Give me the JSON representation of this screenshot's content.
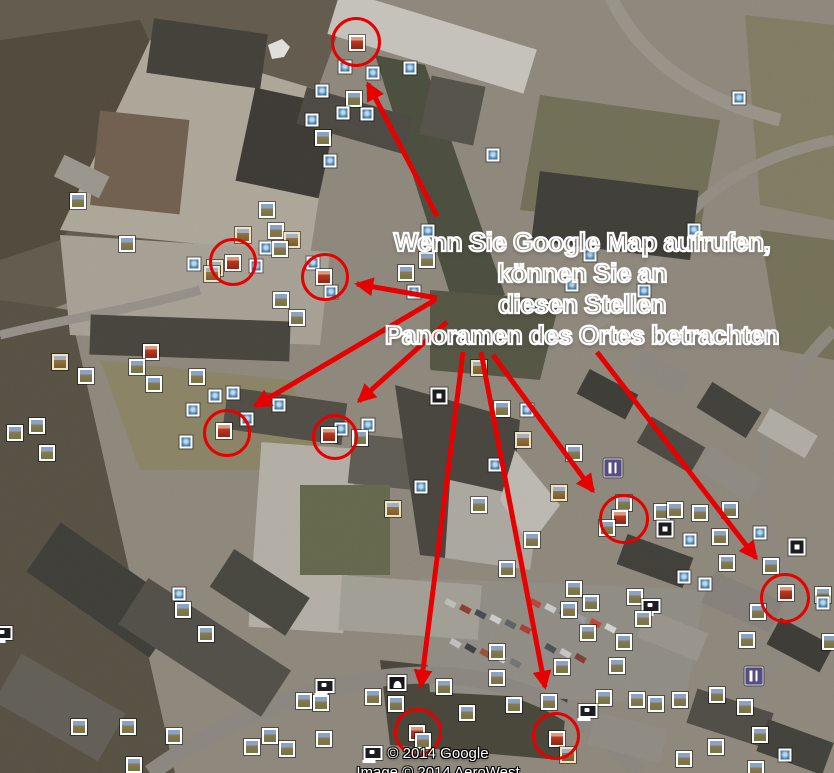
{
  "annotation": {
    "color": "#e60000",
    "text_lines": [
      "Wenn Sie Google Map aufrufen,",
      "können Sie an",
      "diesen Stellen",
      "Panoramen des Ortes betrachten"
    ],
    "circles": [
      {
        "cx": 356,
        "cy": 42,
        "r": 22
      },
      {
        "cx": 233,
        "cy": 262,
        "r": 21
      },
      {
        "cx": 325,
        "cy": 277,
        "r": 21
      },
      {
        "cx": 227,
        "cy": 433,
        "r": 21
      },
      {
        "cx": 335,
        "cy": 437,
        "r": 20
      },
      {
        "cx": 624,
        "cy": 519,
        "r": 22
      },
      {
        "cx": 785,
        "cy": 598,
        "r": 22
      },
      {
        "cx": 418,
        "cy": 732,
        "r": 21
      },
      {
        "cx": 556,
        "cy": 736,
        "r": 21
      }
    ],
    "arrows": [
      {
        "x1": 437,
        "y1": 216,
        "x2": 368,
        "y2": 84
      },
      {
        "x1": 437,
        "y1": 298,
        "x2": 357,
        "y2": 284
      },
      {
        "x1": 435,
        "y1": 300,
        "x2": 255,
        "y2": 406
      },
      {
        "x1": 447,
        "y1": 322,
        "x2": 359,
        "y2": 401
      },
      {
        "x1": 463,
        "y1": 352,
        "x2": 421,
        "y2": 686
      },
      {
        "x1": 481,
        "y1": 352,
        "x2": 545,
        "y2": 687
      },
      {
        "x1": 493,
        "y1": 355,
        "x2": 593,
        "y2": 491
      },
      {
        "x1": 597,
        "y1": 352,
        "x2": 756,
        "y2": 558
      }
    ]
  },
  "attribution": {
    "line1": "© 2014 Google",
    "line2": "Image © 2014 AeroWest"
  },
  "marker_legend": {
    "photo": "photo-placemark",
    "photo2": "photo-placemark-vintage-frame",
    "blue": "small-photo-placemark",
    "red": "highlighted-panorama-placemark",
    "webcam": "webcam-placemark",
    "restaurant": "restaurant-placemark",
    "sphere": "photosphere-placemark",
    "monument": "monument-placemark"
  },
  "markers": [
    [
      357,
      43,
      "red"
    ],
    [
      345,
      67,
      "blue"
    ],
    [
      373,
      73,
      "blue"
    ],
    [
      410,
      68,
      "blue"
    ],
    [
      322,
      91,
      "blue"
    ],
    [
      354,
      99,
      "photo"
    ],
    [
      343,
      113,
      "blue"
    ],
    [
      367,
      114,
      "blue"
    ],
    [
      312,
      120,
      "blue"
    ],
    [
      323,
      138,
      "photo"
    ],
    [
      330,
      161,
      "blue"
    ],
    [
      428,
      231,
      "blue"
    ],
    [
      427,
      260,
      "photo"
    ],
    [
      406,
      273,
      "photo"
    ],
    [
      414,
      292,
      "blue"
    ],
    [
      78,
      201,
      "photo"
    ],
    [
      127,
      244,
      "photo"
    ],
    [
      267,
      210,
      "photo"
    ],
    [
      243,
      235,
      "photo2"
    ],
    [
      276,
      231,
      "photo"
    ],
    [
      292,
      240,
      "photo2"
    ],
    [
      266,
      248,
      "blue"
    ],
    [
      280,
      249,
      "photo"
    ],
    [
      194,
      264,
      "blue"
    ],
    [
      215,
      268,
      "photo2"
    ],
    [
      233,
      263,
      "red"
    ],
    [
      256,
      266,
      "blue"
    ],
    [
      313,
      263,
      "blue"
    ],
    [
      212,
      274,
      "photo2"
    ],
    [
      324,
      277,
      "red"
    ],
    [
      331,
      292,
      "blue"
    ],
    [
      281,
      300,
      "photo"
    ],
    [
      297,
      318,
      "photo"
    ],
    [
      739,
      98,
      "blue"
    ],
    [
      493,
      155,
      "blue"
    ],
    [
      694,
      230,
      "blue"
    ],
    [
      590,
      255,
      "blue"
    ],
    [
      572,
      285,
      "blue"
    ],
    [
      644,
      291,
      "blue"
    ],
    [
      60,
      362,
      "photo2"
    ],
    [
      151,
      352,
      "red"
    ],
    [
      137,
      367,
      "photo"
    ],
    [
      86,
      376,
      "photo"
    ],
    [
      197,
      377,
      "photo"
    ],
    [
      154,
      384,
      "photo"
    ],
    [
      215,
      396,
      "blue"
    ],
    [
      233,
      393,
      "blue"
    ],
    [
      193,
      410,
      "blue"
    ],
    [
      279,
      405,
      "blue"
    ],
    [
      247,
      419,
      "blue"
    ],
    [
      37,
      426,
      "photo"
    ],
    [
      15,
      433,
      "photo"
    ],
    [
      224,
      431,
      "red"
    ],
    [
      47,
      453,
      "photo"
    ],
    [
      186,
      442,
      "blue"
    ],
    [
      341,
      429,
      "blue"
    ],
    [
      368,
      425,
      "blue"
    ],
    [
      360,
      438,
      "photo"
    ],
    [
      329,
      435,
      "red"
    ],
    [
      393,
      509,
      "photo2"
    ],
    [
      479,
      368,
      "photo2"
    ],
    [
      439,
      396,
      "sphere"
    ],
    [
      502,
      409,
      "photo"
    ],
    [
      527,
      410,
      "blue"
    ],
    [
      523,
      440,
      "photo2"
    ],
    [
      495,
      465,
      "blue"
    ],
    [
      421,
      487,
      "blue"
    ],
    [
      574,
      453,
      "photo"
    ],
    [
      559,
      493,
      "photo2"
    ],
    [
      479,
      505,
      "photo"
    ],
    [
      532,
      540,
      "photo"
    ],
    [
      507,
      569,
      "photo"
    ],
    [
      613,
      468,
      "restaurant"
    ],
    [
      624,
      503,
      "photo"
    ],
    [
      620,
      518,
      "red"
    ],
    [
      607,
      528,
      "photo"
    ],
    [
      662,
      512,
      "photo"
    ],
    [
      675,
      510,
      "photo"
    ],
    [
      700,
      513,
      "photo"
    ],
    [
      665,
      529,
      "sphere"
    ],
    [
      690,
      540,
      "blue"
    ],
    [
      720,
      537,
      "photo"
    ],
    [
      730,
      510,
      "photo"
    ],
    [
      760,
      533,
      "blue"
    ],
    [
      727,
      563,
      "photo"
    ],
    [
      771,
      566,
      "photo"
    ],
    [
      797,
      547,
      "sphere"
    ],
    [
      684,
      577,
      "blue"
    ],
    [
      786,
      593,
      "red"
    ],
    [
      823,
      595,
      "photo"
    ],
    [
      179,
      594,
      "blue"
    ],
    [
      183,
      610,
      "photo"
    ],
    [
      206,
      634,
      "photo"
    ],
    [
      3,
      633,
      "webcam"
    ],
    [
      79,
      727,
      "photo"
    ],
    [
      128,
      727,
      "photo"
    ],
    [
      174,
      736,
      "photo"
    ],
    [
      252,
      747,
      "photo"
    ],
    [
      270,
      736,
      "photo"
    ],
    [
      287,
      749,
      "photo"
    ],
    [
      304,
      701,
      "photo"
    ],
    [
      321,
      703,
      "photo"
    ],
    [
      324,
      739,
      "photo"
    ],
    [
      325,
      686,
      "webcam"
    ],
    [
      373,
      697,
      "photo"
    ],
    [
      396,
      704,
      "photo"
    ],
    [
      397,
      683,
      "monument"
    ],
    [
      373,
      753,
      "webcam"
    ],
    [
      134,
      765,
      "photo"
    ],
    [
      417,
      733,
      "red"
    ],
    [
      423,
      741,
      "photo"
    ],
    [
      574,
      589,
      "photo"
    ],
    [
      635,
      597,
      "photo"
    ],
    [
      591,
      603,
      "photo"
    ],
    [
      569,
      610,
      "photo"
    ],
    [
      705,
      584,
      "blue"
    ],
    [
      651,
      606,
      "webcam"
    ],
    [
      643,
      619,
      "photo"
    ],
    [
      588,
      633,
      "photo"
    ],
    [
      624,
      642,
      "photo"
    ],
    [
      617,
      666,
      "photo"
    ],
    [
      562,
      667,
      "photo"
    ],
    [
      497,
      652,
      "photo"
    ],
    [
      497,
      678,
      "photo"
    ],
    [
      514,
      705,
      "photo"
    ],
    [
      444,
      687,
      "photo"
    ],
    [
      467,
      713,
      "photo"
    ],
    [
      549,
      702,
      "photo"
    ],
    [
      604,
      698,
      "photo"
    ],
    [
      588,
      711,
      "webcam"
    ],
    [
      637,
      700,
      "photo"
    ],
    [
      656,
      704,
      "photo"
    ],
    [
      680,
      700,
      "photo"
    ],
    [
      717,
      695,
      "photo"
    ],
    [
      745,
      707,
      "photo"
    ],
    [
      716,
      747,
      "photo"
    ],
    [
      760,
      735,
      "photo"
    ],
    [
      785,
      755,
      "blue"
    ],
    [
      756,
      769,
      "photo"
    ],
    [
      758,
      612,
      "photo"
    ],
    [
      747,
      640,
      "photo"
    ],
    [
      823,
      603,
      "blue"
    ],
    [
      830,
      642,
      "photo"
    ],
    [
      754,
      676,
      "restaurant"
    ],
    [
      557,
      739,
      "red"
    ],
    [
      568,
      755,
      "photo2"
    ],
    [
      684,
      759,
      "photo"
    ]
  ]
}
